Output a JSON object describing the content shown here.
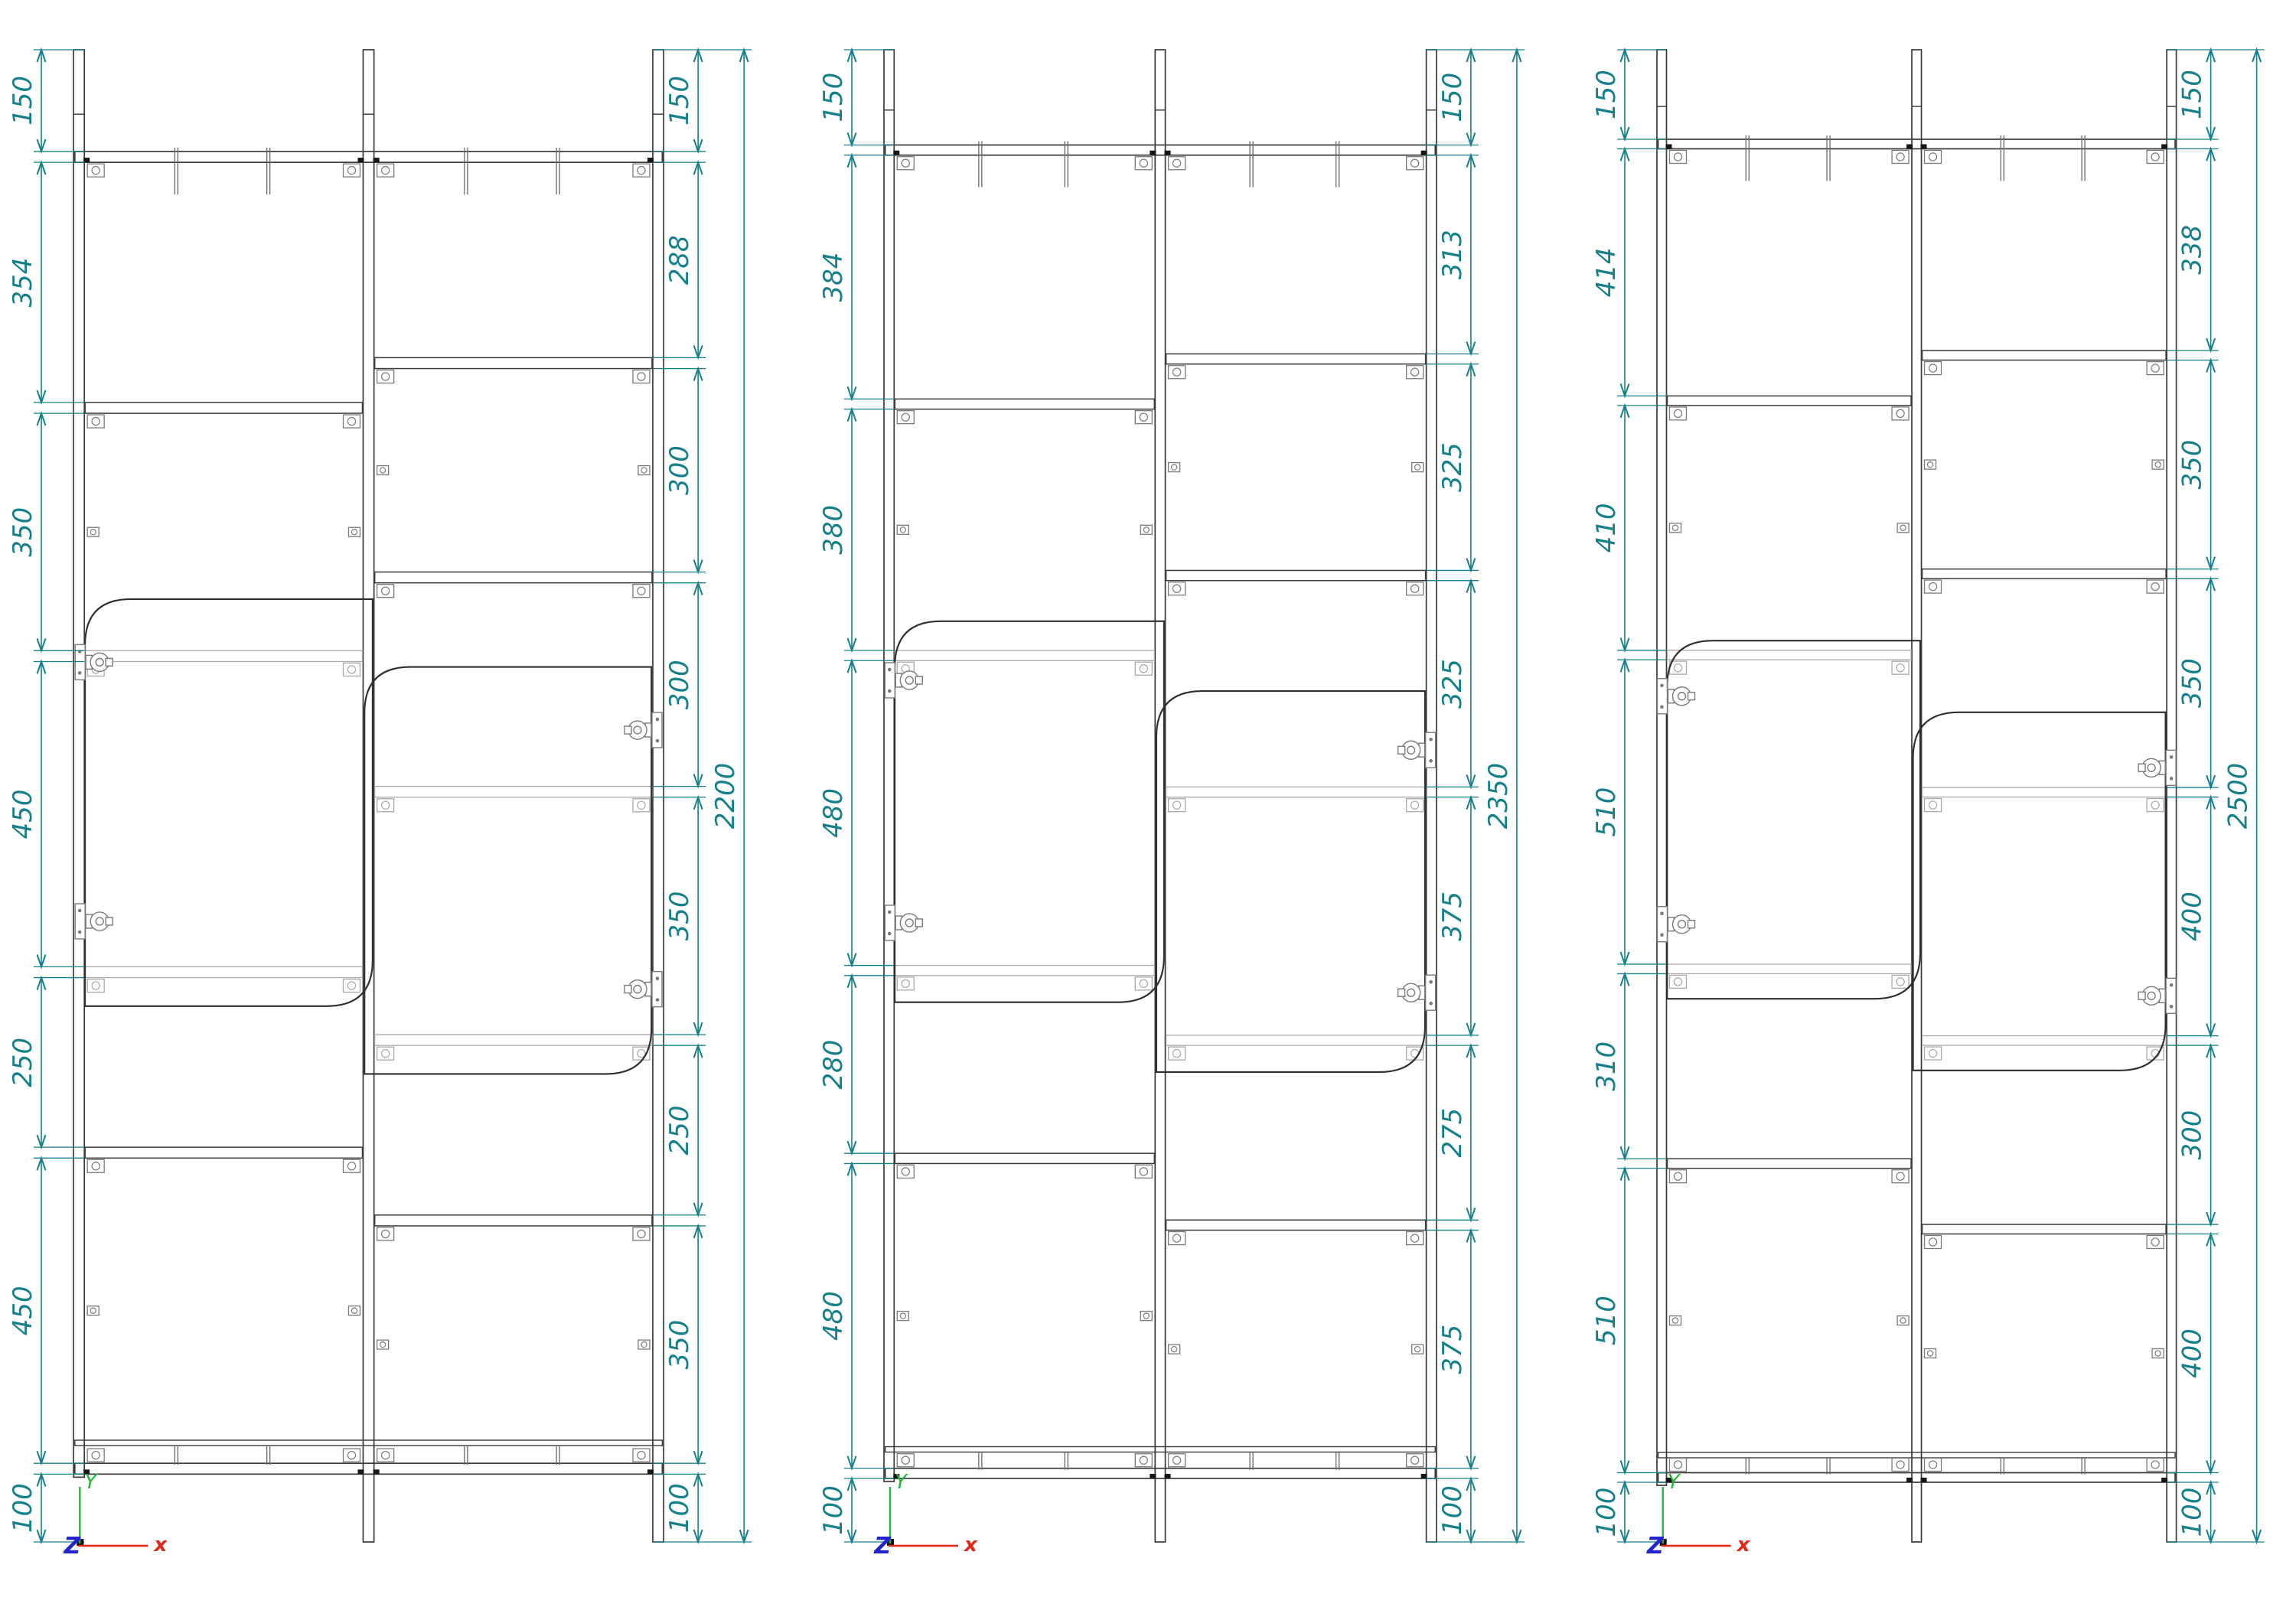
{
  "colors": {
    "background": "#ffffff",
    "dimension": "#16808a",
    "structure": "#3a3a3a",
    "structure_light": "#a9a9a9",
    "hardware": "#7a7a7a",
    "corner_mark": "#161616",
    "axis_x": "#e42718",
    "axis_y": "#27b43a",
    "axis_z": "#2424cf"
  },
  "ucs": {
    "x_label": "x",
    "y_label": "Y",
    "z_label": "Z"
  },
  "drawings": [
    {
      "id": "elevation-2200",
      "overall_label": "2200",
      "left_dims": [
        "150",
        "354",
        "350",
        "450",
        "250",
        "450",
        "100"
      ],
      "right_dims": [
        "150",
        "288",
        "300",
        "300",
        "350",
        "250",
        "350",
        "100"
      ]
    },
    {
      "id": "elevation-2350",
      "overall_label": "2350",
      "left_dims": [
        "150",
        "384",
        "380",
        "480",
        "280",
        "480",
        "100"
      ],
      "right_dims": [
        "150",
        "313",
        "325",
        "325",
        "375",
        "275",
        "375",
        "100"
      ]
    },
    {
      "id": "elevation-2500",
      "overall_label": "2500",
      "left_dims": [
        "150",
        "414",
        "410",
        "510",
        "310",
        "510",
        "100"
      ],
      "right_dims": [
        "150",
        "338",
        "350",
        "350",
        "400",
        "300",
        "400",
        "100"
      ]
    }
  ]
}
